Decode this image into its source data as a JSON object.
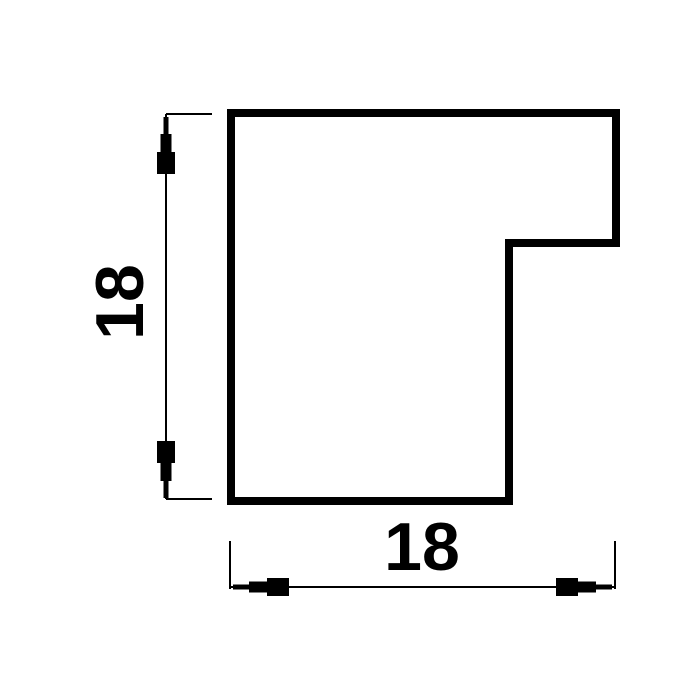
{
  "drawing": {
    "kind": "technical-cross-section-profile",
    "background_color": "#ffffff",
    "line_color": "#000000",
    "dimensions": {
      "height": {
        "value": "18",
        "orientation": "vertical"
      },
      "width": {
        "value": "18",
        "orientation": "horizontal"
      }
    }
  }
}
